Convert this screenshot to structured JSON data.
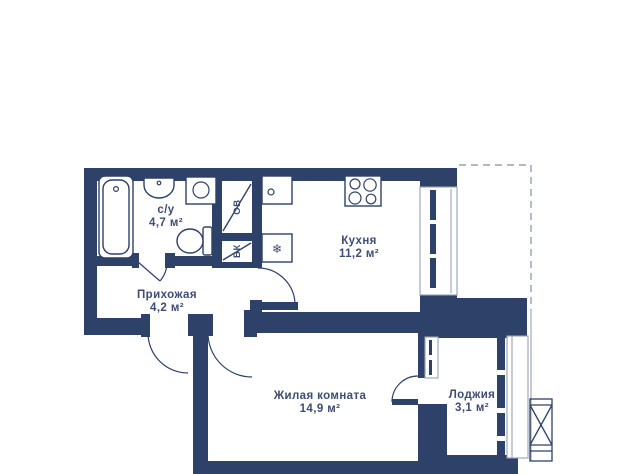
{
  "colors": {
    "wall": "#2e4168",
    "text": "#3d4d73",
    "thin_line": "#98a1b3",
    "background": "#ffffff"
  },
  "rooms": {
    "bathroom": {
      "name": "с/у",
      "area": "4,7 м²"
    },
    "hallway": {
      "name": "Прихожая",
      "area": "4,2 м²"
    },
    "kitchen": {
      "name": "Кухня",
      "area": "11,2 м²"
    },
    "living_room": {
      "name": "Жилая комната",
      "area": "14,9 м²"
    },
    "loggia": {
      "name": "Лоджия",
      "area": "3,1 м²"
    }
  },
  "shafts": {
    "heating": {
      "label": "ОВ"
    },
    "water": {
      "label": "ВК"
    }
  },
  "symbols": {
    "fridge": "❄"
  }
}
